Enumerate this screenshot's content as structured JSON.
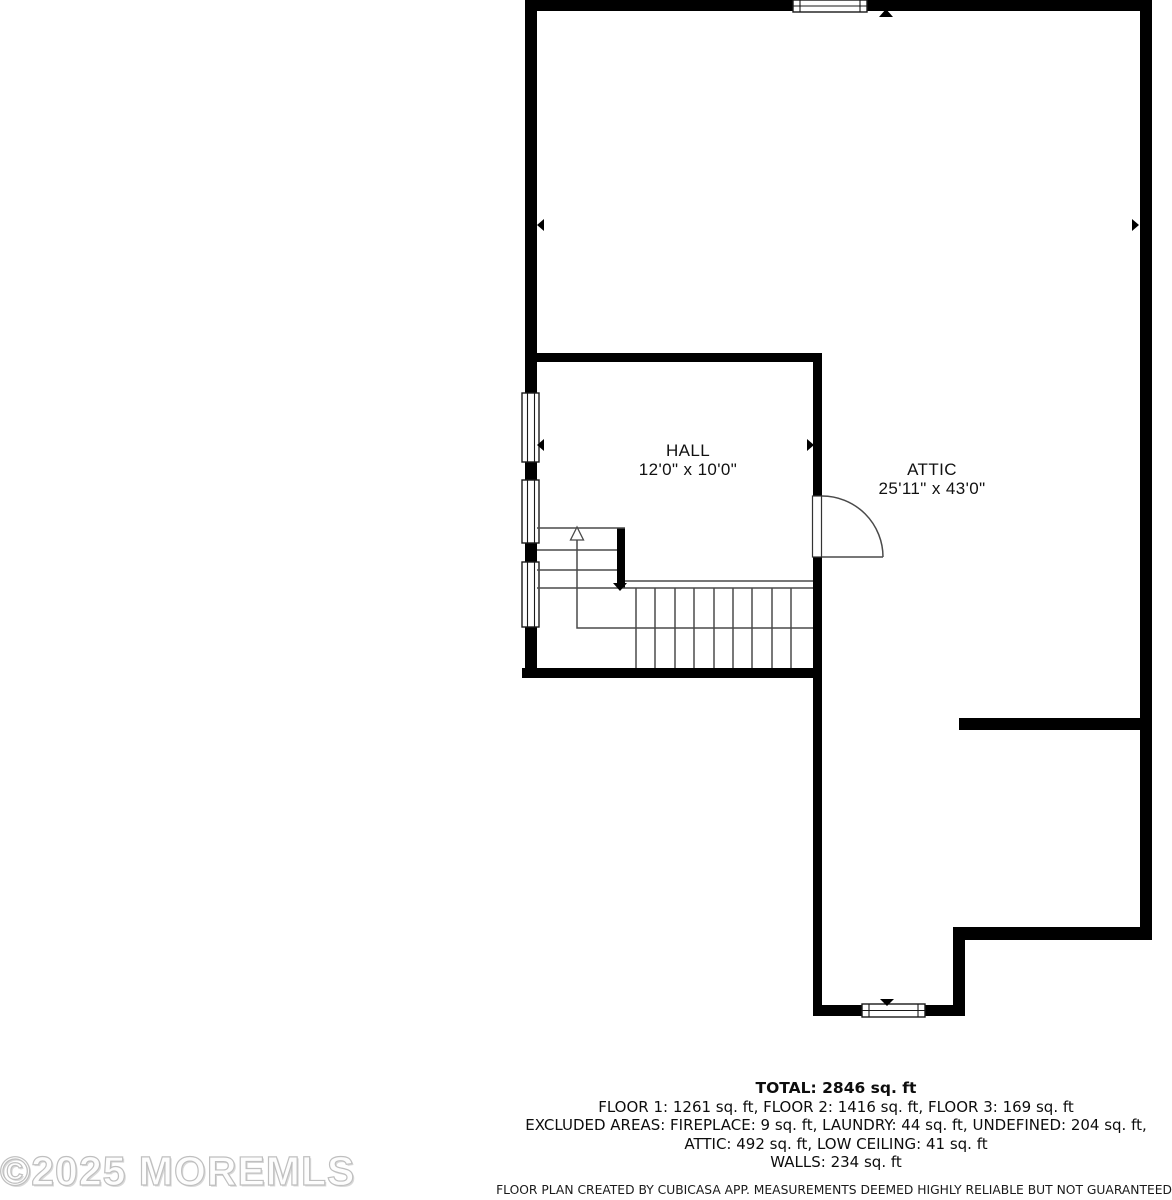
{
  "plan": {
    "rooms": [
      {
        "name": "HALL",
        "dimensions": "12'0\" x 10'0\""
      },
      {
        "name": "ATTIC",
        "dimensions": "25'11\" x 43'0\""
      }
    ]
  },
  "summary": {
    "total": "TOTAL: 2846 sq. ft",
    "floors": "FLOOR 1: 1261 sq. ft, FLOOR 2: 1416 sq. ft, FLOOR 3: 169 sq. ft",
    "excluded_line1": "EXCLUDED AREAS: FIREPLACE: 9 sq. ft, LAUNDRY: 44 sq. ft, UNDEFINED: 204 sq. ft,",
    "excluded_line2": "ATTIC: 492 sq. ft, LOW CEILING: 41 sq. ft",
    "walls": "WALLS: 234 sq. ft",
    "disclaimer": "FLOOR PLAN CREATED BY CUBICASA APP. MEASUREMENTS DEEMED HIGHLY RELIABLE BUT NOT GUARANTEED."
  },
  "watermark": "©2025 MOREMLS",
  "colors": {
    "wall": "#000000",
    "thin_line": "#4a4a4a",
    "text": "#111111",
    "watermark": "#bfbfbf"
  }
}
